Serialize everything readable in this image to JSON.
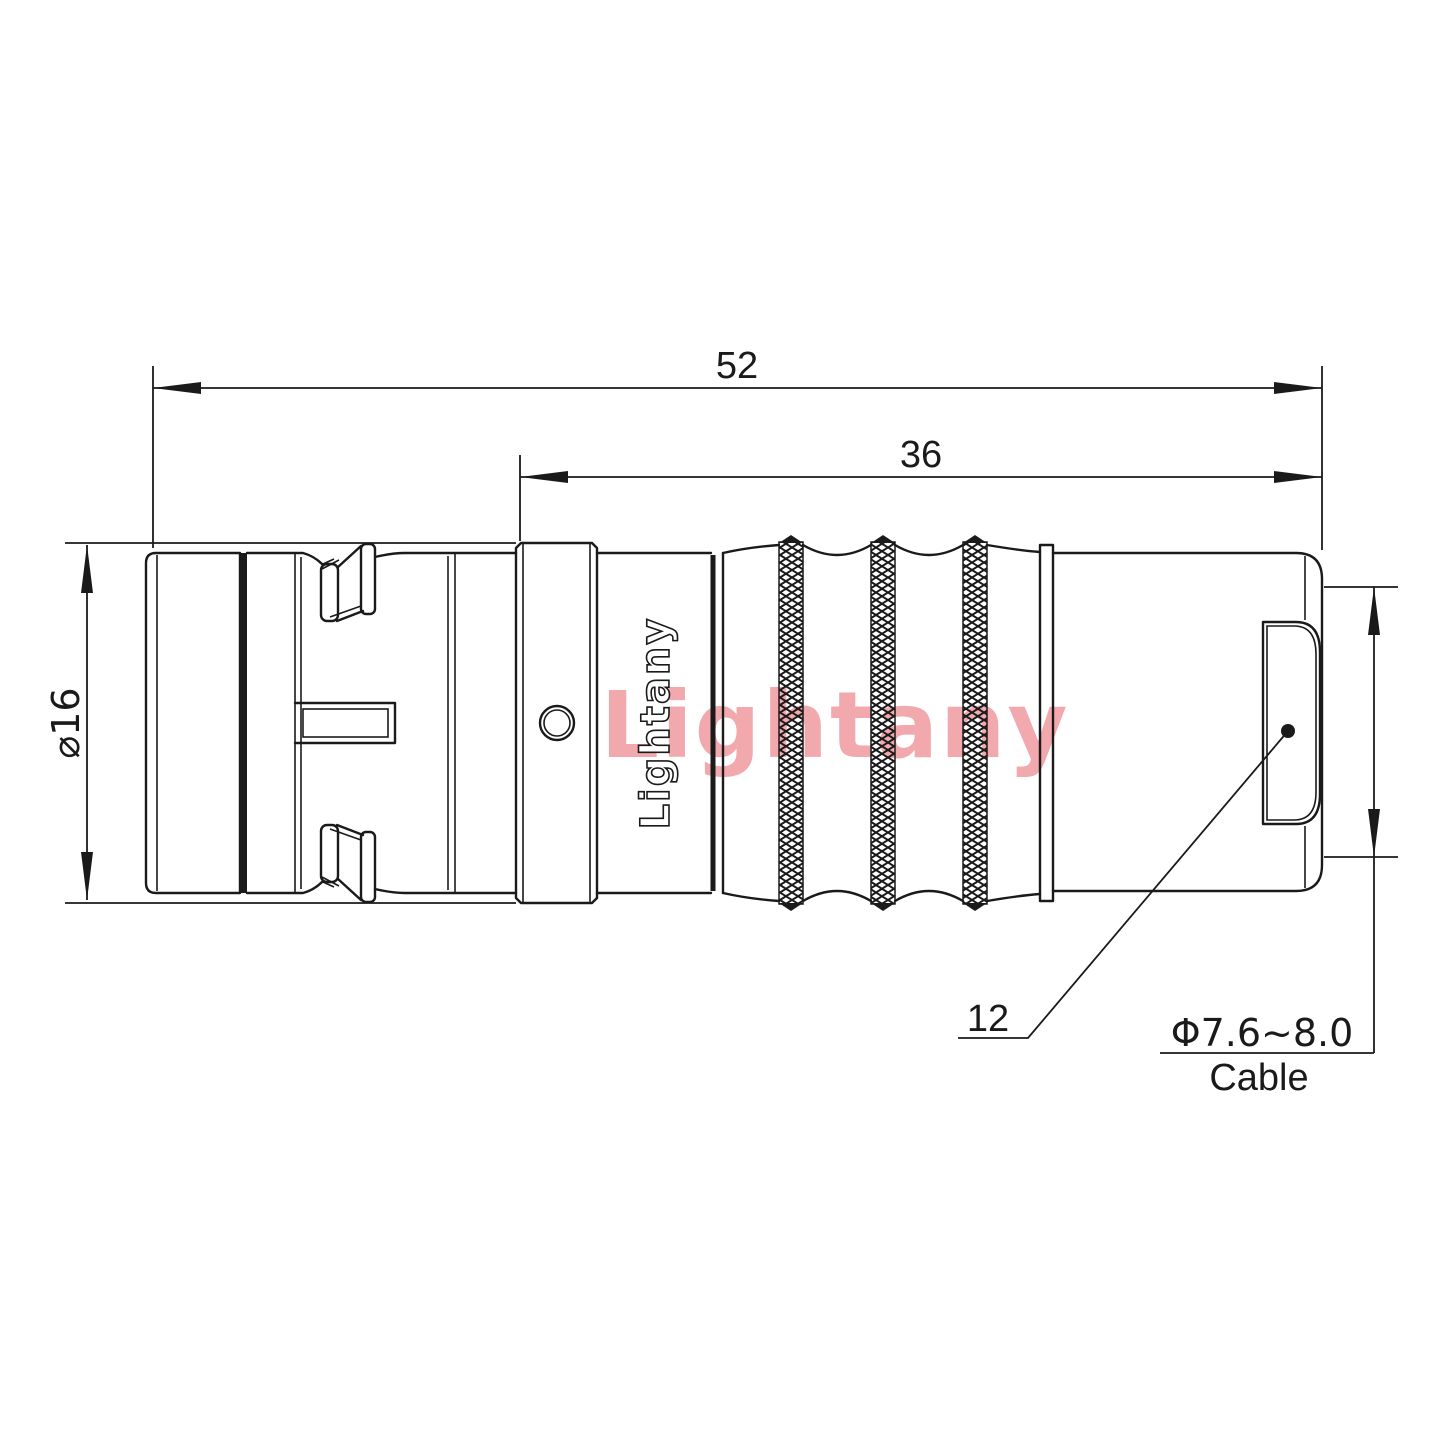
{
  "drawing": {
    "title": "connector-technical-drawing",
    "watermark": "Lightany",
    "logo_engraving": "Lightany",
    "dimensions": {
      "total_length": "52",
      "front_length": "36",
      "shell_diameter": "⌀16",
      "rear_diameter": "12",
      "cable_range": "Φ7.6~8.0",
      "cable_label": "Cable"
    },
    "colors": {
      "line": "#1a1a1a",
      "watermark": "#f2a9ae",
      "background": "#ffffff"
    }
  }
}
